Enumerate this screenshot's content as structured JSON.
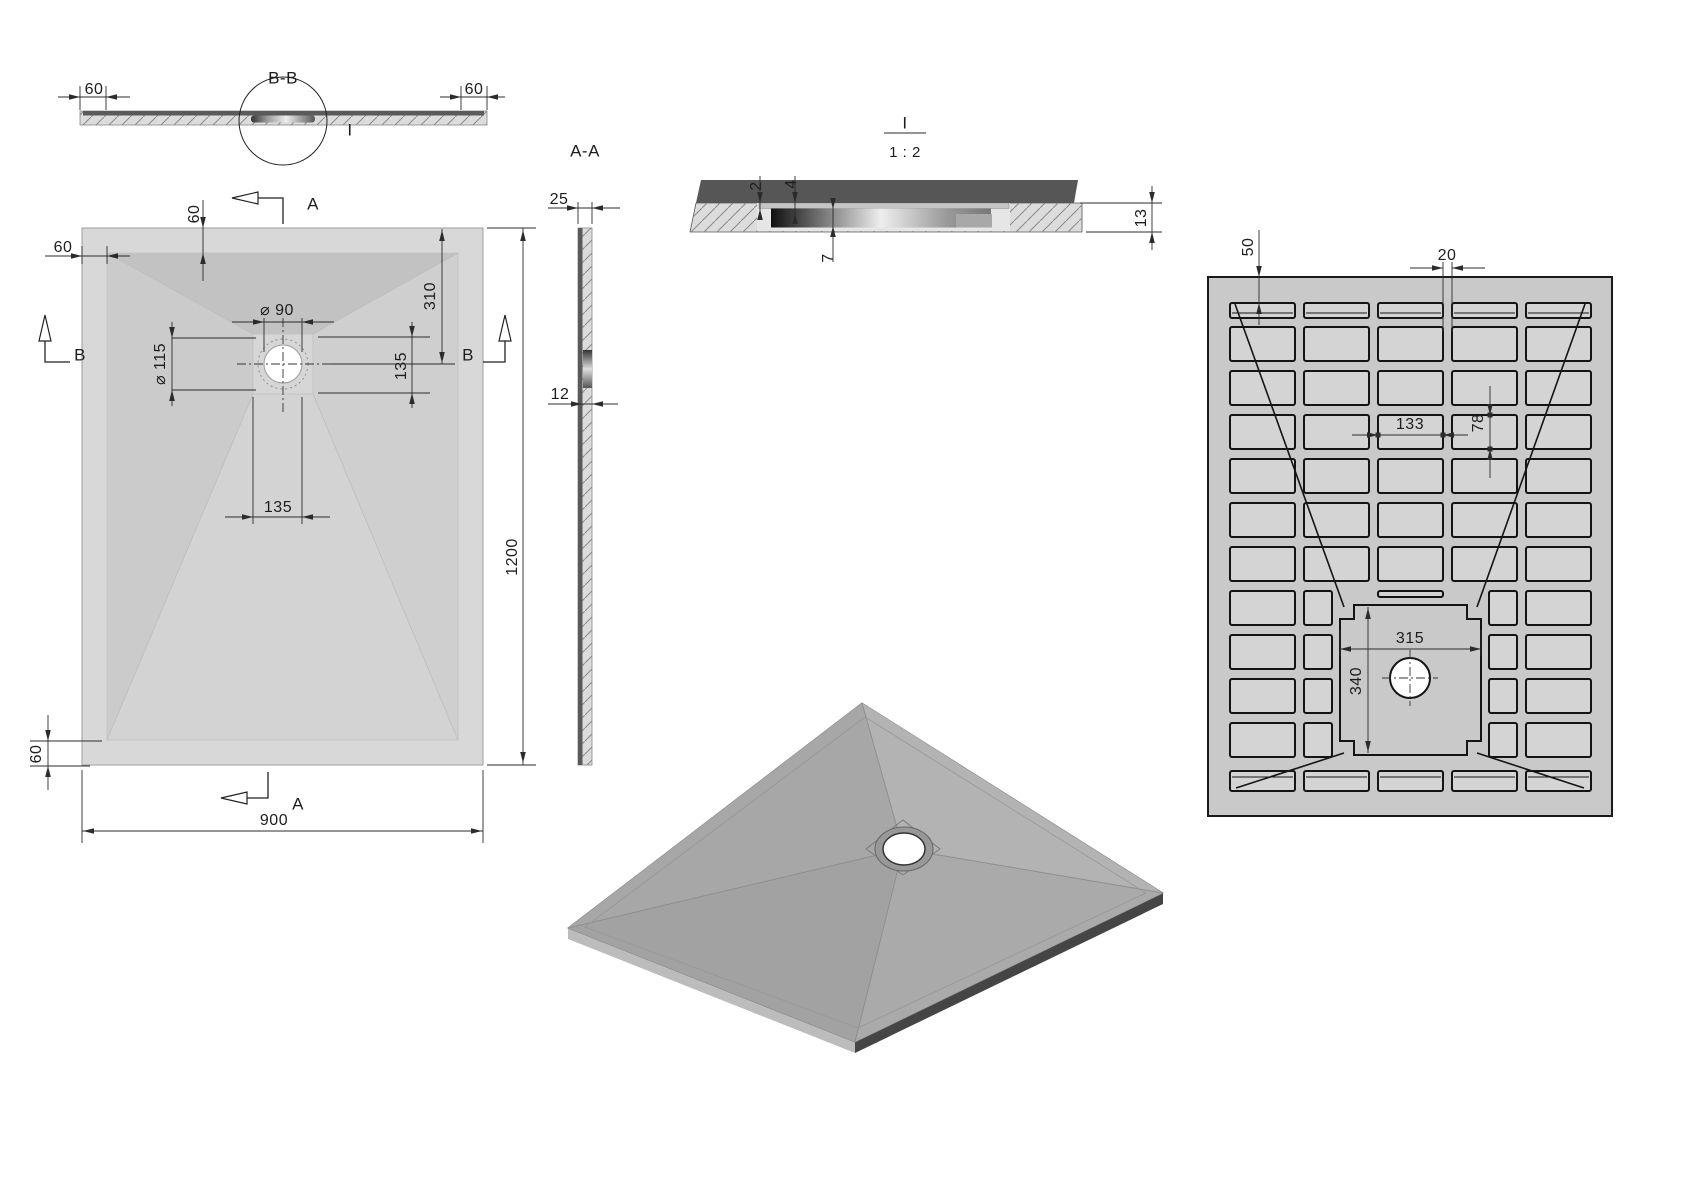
{
  "page": {
    "background": "#ffffff",
    "type": "technical-drawing-shower-tray"
  },
  "views": {
    "section_bb": {
      "label": "B-B",
      "detail_marker": "I",
      "dims": {
        "left_border": "60",
        "right_border": "60"
      }
    },
    "plan": {
      "section_arrows": {
        "top": "A",
        "bottom": "A",
        "left": "B",
        "right": "B"
      },
      "dims": {
        "top_border": "60",
        "left_border": "60",
        "drain_hole_dia": "⌀ 90",
        "drain_flange_dia": "⌀ 115",
        "drain_center_from_top": "310",
        "flat_zone_height": "135",
        "flat_zone_width": "135",
        "tray_length": "1200",
        "tray_width": "900",
        "bottom_border": "60"
      }
    },
    "section_aa": {
      "label": "A-A",
      "dims": {
        "rim_thickness": "25",
        "center_thickness": "12"
      }
    },
    "detail_i": {
      "label": "I",
      "scale": "1 : 2",
      "dims": {
        "top_lip": "2",
        "flange_recess": "4",
        "cover_depth": "7",
        "total_thickness": "13"
      }
    },
    "bottom": {
      "dims": {
        "edge_margin": "50",
        "rib_width": "20",
        "pocket_width": "133",
        "pocket_height": "78",
        "flat_zone_width": "315",
        "flat_zone_height": "340"
      }
    }
  },
  "colors": {
    "tray_fill": "#d8d8d8",
    "slope_dark": "#c2c2c2",
    "bottom_view_fill": "#c9c9c9",
    "pocket_fill": "#d4d4d4",
    "iso_top": "#a6a6a6",
    "iso_side_dark": "#454545",
    "section_dark_band": "#5a5a5a",
    "dim_line": "#2b2b2b"
  }
}
